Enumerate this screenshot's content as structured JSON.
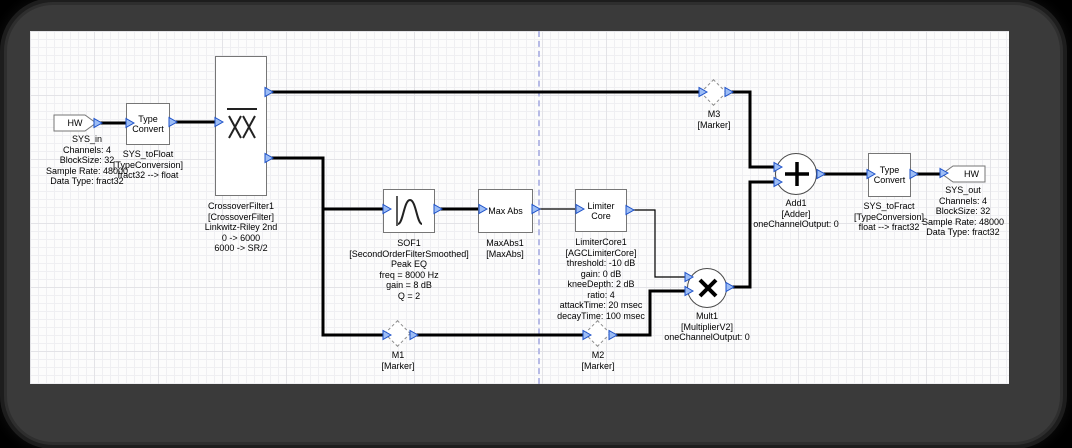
{
  "window": {
    "background": "#000000",
    "frame_color": "#3a3a3a",
    "canvas_color": "#fcfcfc"
  },
  "palette": {
    "wire_color": "#000000",
    "pin_fill": "#9dbdf5",
    "pin_stroke": "#1b50c8",
    "marker_border": "#8a8a8a",
    "guide_line_color": "#b7bbe6"
  },
  "blocks": {
    "sys_in": {
      "label": "HW",
      "caption": "SYS_in\nChannels: 4\nBlockSize: 32\nSample Rate: 48000\nData Type: fract32"
    },
    "sys_to_float": {
      "label": "Type\nConvert",
      "caption": "SYS_toFloat\n[TypeConversion]\nfract32 --> float"
    },
    "crossover": {
      "icon": "crossover-filter-icon",
      "caption": "CrossoverFilter1\n[CrossoverFilter]\nLinkwitz-Riley 2nd\n0 -> 6000\n6000 -> SR/2"
    },
    "sof1": {
      "icon": "peak-eq-curve-icon",
      "caption": "SOF1\n[SecondOrderFilterSmoothed]\nPeak EQ\nfreq = 8000 Hz\ngain = 8 dB\nQ = 2"
    },
    "max_abs": {
      "label": "Max Abs",
      "caption": "MaxAbs1\n[MaxAbs]"
    },
    "limiter_core": {
      "label": "Limiter\nCore",
      "caption": "LimiterCore1\n[AGCLimiterCore]\nthreshold: -10 dB\ngain: 0 dB\nkneeDepth: 2 dB\nratio: 4\nattackTime: 20 msec\ndecayTime: 100 msec"
    },
    "mult1": {
      "symbol": "×",
      "caption": "Mult1\n[MultiplierV2]\noneChannelOutput: 0"
    },
    "add1": {
      "symbol": "+",
      "caption": "Add1\n[Adder]\noneChannelOutput: 0"
    },
    "sys_to_fract": {
      "label": "Type\nConvert",
      "caption": "SYS_toFract\n[TypeConversion]\nfloat --> fract32"
    },
    "sys_out": {
      "label": "HW",
      "caption": "SYS_out\nChannels: 4\nBlockSize: 32\nSample Rate: 48000\nData Type: fract32"
    }
  },
  "markers": {
    "m1": {
      "caption": "M1\n[Marker]"
    },
    "m2": {
      "caption": "M2\n[Marker]"
    },
    "m3": {
      "caption": "M3\n[Marker]"
    }
  }
}
